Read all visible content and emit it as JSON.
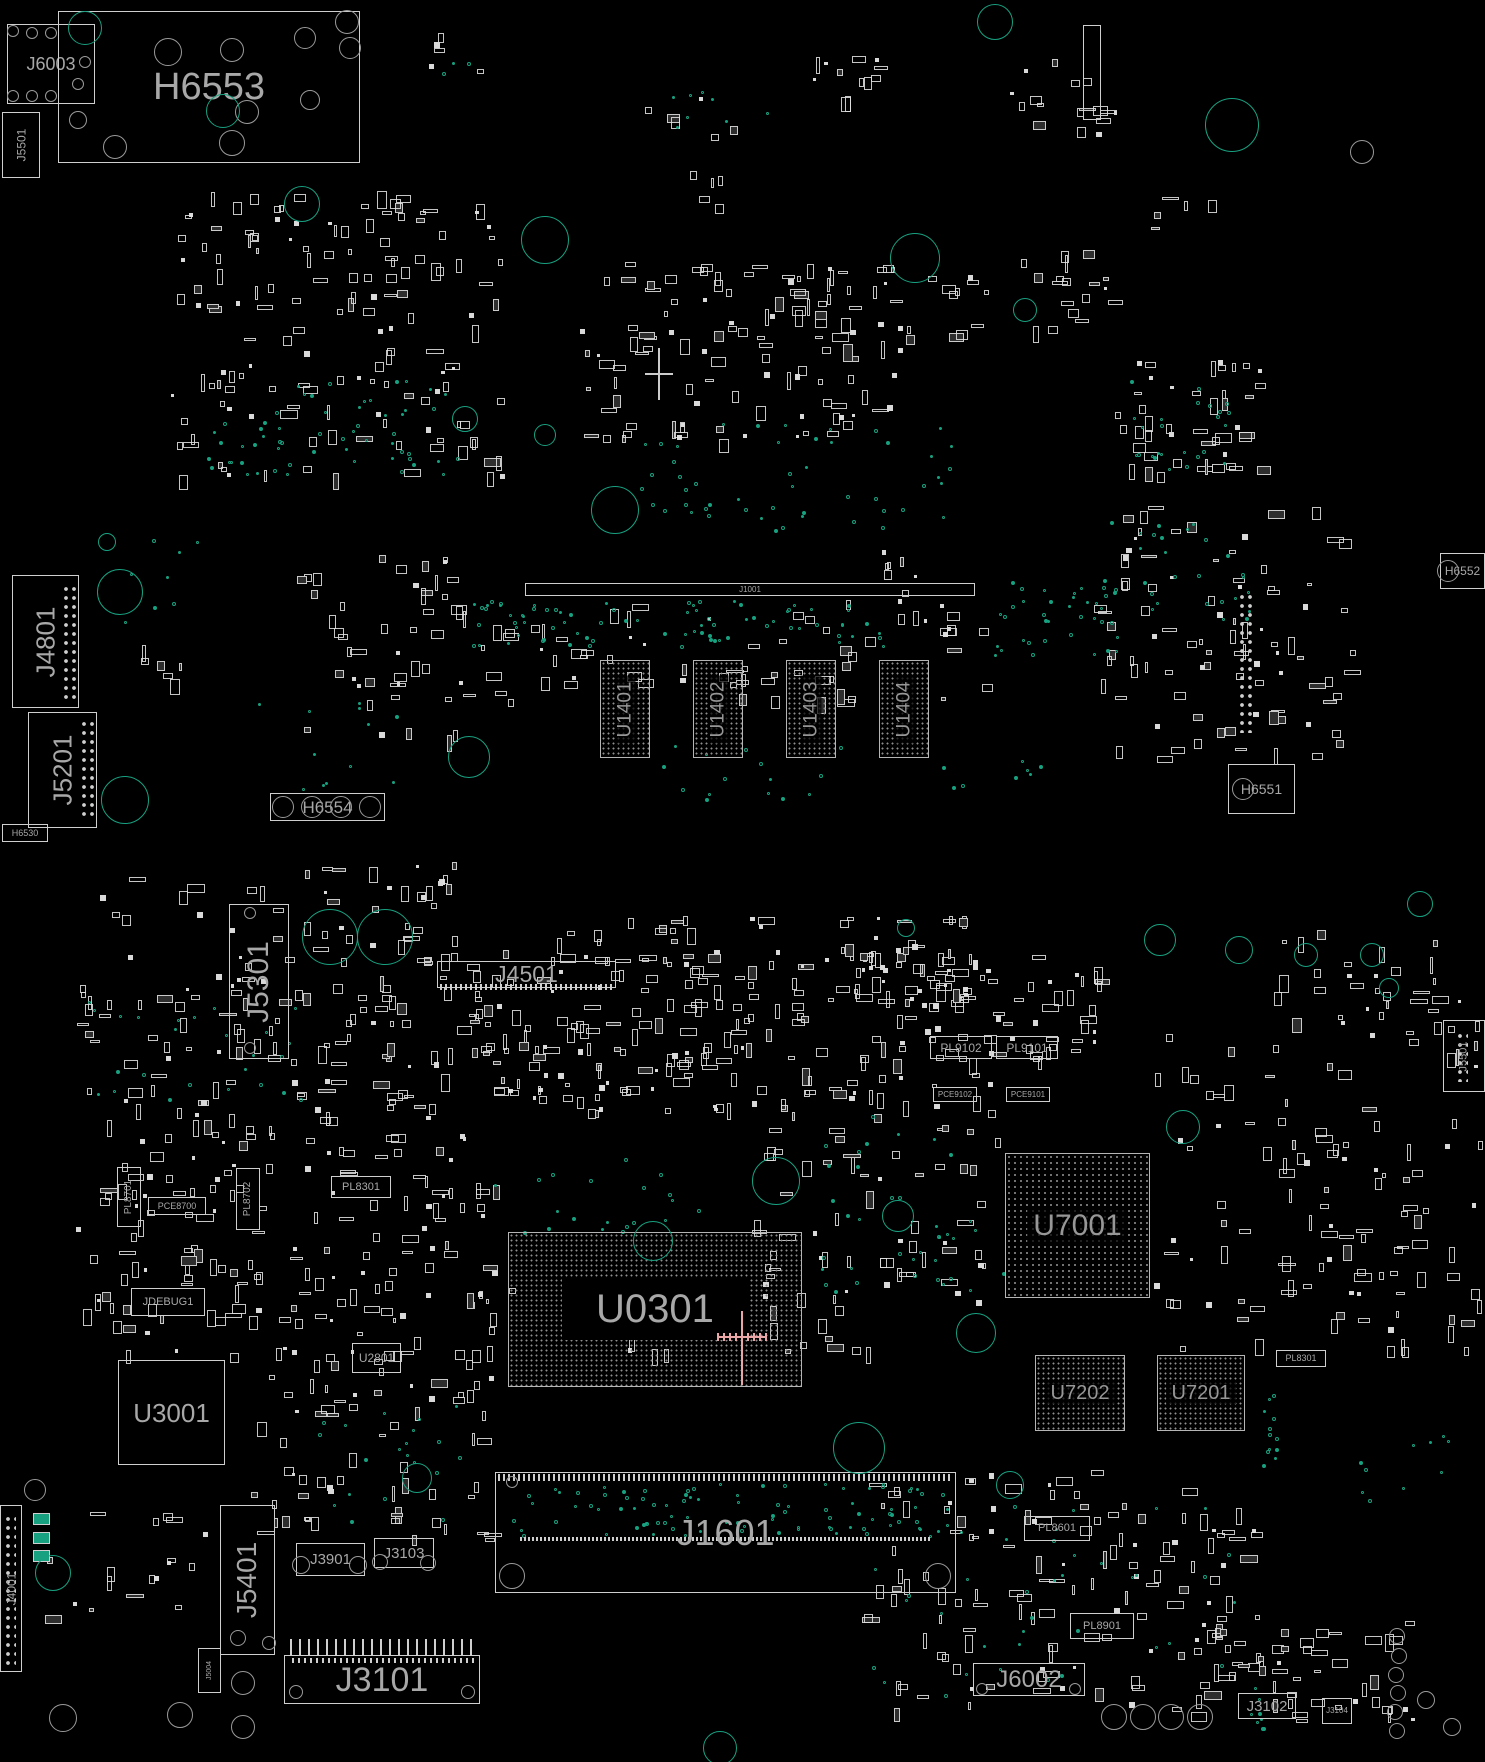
{
  "board": {
    "width": 1485,
    "height": 1762
  },
  "colors": {
    "background": "#000000",
    "outline": "#cfcfcf",
    "label": "#a8a8a8",
    "teal": "#17a180",
    "hole": "#9a9a9a",
    "highlight_cross": "#eaa6a6",
    "white_cross": "#cccccc",
    "bga_dot": "#8f8f8f",
    "pad_fill": "#d9d9d9"
  },
  "components": [
    {
      "label": "J6003",
      "x": 7,
      "y": 24,
      "w": 88,
      "h": 80,
      "type": "outline",
      "fs": 18,
      "dir": "h"
    },
    {
      "label": "H6553",
      "x": 58,
      "y": 11,
      "w": 302,
      "h": 152,
      "type": "outline",
      "fs": 38,
      "dir": "h"
    },
    {
      "label": "J5501",
      "x": 2,
      "y": 112,
      "w": 38,
      "h": 66,
      "type": "outline",
      "fs": 12,
      "dir": "v"
    },
    {
      "label": "J4801",
      "x": 12,
      "y": 575,
      "w": 67,
      "h": 133,
      "type": "outline",
      "fs": 26,
      "dir": "v"
    },
    {
      "label": "J5201",
      "x": 28,
      "y": 712,
      "w": 69,
      "h": 116,
      "type": "outline",
      "fs": 26,
      "dir": "v"
    },
    {
      "label": "H6530",
      "x": 2,
      "y": 824,
      "w": 46,
      "h": 18,
      "type": "outline",
      "fs": 9,
      "dir": "h"
    },
    {
      "label": "H6554",
      "x": 270,
      "y": 793,
      "w": 115,
      "h": 28,
      "type": "outline",
      "fs": 17,
      "dir": "h"
    },
    {
      "label": "J1001",
      "x": 525,
      "y": 583,
      "w": 450,
      "h": 13,
      "type": "outline",
      "fs": 8,
      "dir": "h"
    },
    {
      "label": "U1401",
      "x": 600,
      "y": 660,
      "w": 50,
      "h": 98,
      "type": "bga",
      "fs": 19,
      "dir": "v"
    },
    {
      "label": "U1402",
      "x": 693,
      "y": 660,
      "w": 50,
      "h": 98,
      "type": "bga",
      "fs": 19,
      "dir": "v"
    },
    {
      "label": "U1403",
      "x": 786,
      "y": 660,
      "w": 50,
      "h": 98,
      "type": "bga",
      "fs": 19,
      "dir": "v"
    },
    {
      "label": "U1404",
      "x": 879,
      "y": 660,
      "w": 50,
      "h": 98,
      "type": "bga",
      "fs": 19,
      "dir": "v"
    },
    {
      "label": "H6551",
      "x": 1228,
      "y": 764,
      "w": 67,
      "h": 50,
      "type": "outline",
      "fs": 14,
      "dir": "h"
    },
    {
      "label": "H6552",
      "x": 1440,
      "y": 553,
      "w": 45,
      "h": 36,
      "type": "outline",
      "fs": 12,
      "dir": "h"
    },
    {
      "label": "J5301",
      "x": 229,
      "y": 904,
      "w": 60,
      "h": 155,
      "type": "outline",
      "fs": 30,
      "dir": "v"
    },
    {
      "label": "J4501",
      "x": 437,
      "y": 961,
      "w": 179,
      "h": 27,
      "type": "outline",
      "fs": 23,
      "dir": "h"
    },
    {
      "label": "U0301",
      "x": 508,
      "y": 1232,
      "w": 294,
      "h": 155,
      "type": "bga",
      "fs": 40,
      "dir": "h",
      "panel": true
    },
    {
      "label": "U7001",
      "x": 1005,
      "y": 1153,
      "w": 145,
      "h": 145,
      "type": "bga",
      "fs": 30,
      "dir": "h"
    },
    {
      "label": "U7202",
      "x": 1035,
      "y": 1355,
      "w": 90,
      "h": 76,
      "type": "bga",
      "fs": 20,
      "dir": "h"
    },
    {
      "label": "U7201",
      "x": 1157,
      "y": 1355,
      "w": 88,
      "h": 76,
      "type": "bga",
      "fs": 20,
      "dir": "h"
    },
    {
      "label": "U3001",
      "x": 118,
      "y": 1360,
      "w": 107,
      "h": 105,
      "type": "outline",
      "fs": 26,
      "dir": "h"
    },
    {
      "label": "U2801",
      "x": 352,
      "y": 1343,
      "w": 49,
      "h": 30,
      "type": "outline",
      "fs": 12,
      "dir": "h"
    },
    {
      "label": "JDEBUG1",
      "x": 131,
      "y": 1288,
      "w": 74,
      "h": 28,
      "type": "outline",
      "fs": 11,
      "dir": "h"
    },
    {
      "label": "PL8701",
      "x": 117,
      "y": 1167,
      "w": 24,
      "h": 60,
      "type": "outline",
      "fs": 10,
      "dir": "v"
    },
    {
      "label": "PL8702",
      "x": 236,
      "y": 1168,
      "w": 24,
      "h": 62,
      "type": "outline",
      "fs": 10,
      "dir": "v"
    },
    {
      "label": "PCE8700",
      "x": 148,
      "y": 1197,
      "w": 58,
      "h": 18,
      "type": "outline",
      "fs": 9,
      "dir": "h"
    },
    {
      "label": "PL8301",
      "x": 331,
      "y": 1176,
      "w": 60,
      "h": 22,
      "type": "outline",
      "fs": 11,
      "dir": "h"
    },
    {
      "label": "PL9102",
      "x": 930,
      "y": 1036,
      "w": 62,
      "h": 23,
      "type": "outline",
      "fs": 12,
      "dir": "h"
    },
    {
      "label": "PL9101",
      "x": 996,
      "y": 1036,
      "w": 62,
      "h": 23,
      "type": "outline",
      "fs": 12,
      "dir": "h"
    },
    {
      "label": "PCE9102",
      "x": 933,
      "y": 1087,
      "w": 44,
      "h": 15,
      "type": "outline",
      "fs": 8,
      "dir": "h"
    },
    {
      "label": "PCE9101",
      "x": 1006,
      "y": 1087,
      "w": 44,
      "h": 15,
      "type": "outline",
      "fs": 8,
      "dir": "h"
    },
    {
      "label": "PL8301",
      "x": 1276,
      "y": 1350,
      "w": 50,
      "h": 17,
      "type": "outline",
      "fs": 9,
      "dir": "h"
    },
    {
      "label": "J1601",
      "x": 495,
      "y": 1472,
      "w": 461,
      "h": 121,
      "type": "outline",
      "fs": 36,
      "dir": "h"
    },
    {
      "label": "J5401",
      "x": 220,
      "y": 1505,
      "w": 55,
      "h": 150,
      "type": "outline",
      "fs": 28,
      "dir": "v"
    },
    {
      "label": "J3901",
      "x": 296,
      "y": 1543,
      "w": 69,
      "h": 33,
      "type": "outline",
      "fs": 15,
      "dir": "h"
    },
    {
      "label": "J3103",
      "x": 374,
      "y": 1538,
      "w": 60,
      "h": 30,
      "type": "outline",
      "fs": 15,
      "dir": "h"
    },
    {
      "label": "J3101",
      "x": 284,
      "y": 1655,
      "w": 196,
      "h": 49,
      "type": "outline",
      "fs": 34,
      "dir": "h"
    },
    {
      "label": "J5004",
      "x": 198,
      "y": 1648,
      "w": 23,
      "h": 45,
      "type": "outline",
      "fs": 7,
      "dir": "v"
    },
    {
      "label": "J4001",
      "x": 0,
      "y": 1505,
      "w": 22,
      "h": 167,
      "type": "outline",
      "fs": 12,
      "dir": "v"
    },
    {
      "label": "J6002",
      "x": 973,
      "y": 1663,
      "w": 112,
      "h": 33,
      "type": "outline",
      "fs": 24,
      "dir": "h"
    },
    {
      "label": "PL8601",
      "x": 1024,
      "y": 1516,
      "w": 66,
      "h": 25,
      "type": "outline",
      "fs": 11,
      "dir": "h"
    },
    {
      "label": "PL8901",
      "x": 1070,
      "y": 1613,
      "w": 64,
      "h": 26,
      "type": "outline",
      "fs": 11,
      "dir": "h"
    },
    {
      "label": "J3102",
      "x": 1238,
      "y": 1693,
      "w": 58,
      "h": 26,
      "type": "outline",
      "fs": 15,
      "dir": "h"
    },
    {
      "label": "J3104",
      "x": 1322,
      "y": 1698,
      "w": 30,
      "h": 26,
      "type": "outline",
      "fs": 8,
      "dir": "h"
    },
    {
      "label": "J5501",
      "x": 1443,
      "y": 1020,
      "w": 42,
      "h": 72,
      "type": "outline",
      "fs": 11,
      "dir": "v"
    },
    {
      "label": "",
      "x": 1083,
      "y": 25,
      "w": 18,
      "h": 95,
      "type": "outline",
      "fs": 0,
      "dir": "v"
    }
  ],
  "pad_columns": [
    [
      62,
      585,
      16,
      115
    ],
    [
      80,
      720,
      16,
      100
    ],
    [
      1238,
      593,
      16,
      140
    ],
    [
      4,
      1515,
      12,
      150
    ],
    [
      1456,
      1032,
      12,
      50
    ]
  ],
  "pin_strips": [
    [
      440,
      984,
      172,
      6,
      5
    ],
    [
      498,
      1474,
      455,
      7,
      5
    ],
    [
      520,
      1537,
      412,
      4,
      4
    ],
    [
      290,
      1639,
      186,
      16,
      9
    ],
    [
      292,
      1658,
      182,
      5,
      6
    ]
  ],
  "circles": [
    [
      168,
      52,
      14,
      "g"
    ],
    [
      232,
      50,
      12,
      "g"
    ],
    [
      305,
      38,
      11,
      "g"
    ],
    [
      347,
      22,
      12,
      "g"
    ],
    [
      350,
      48,
      11,
      "g"
    ],
    [
      310,
      100,
      10,
      "g"
    ],
    [
      232,
      143,
      13,
      "g"
    ],
    [
      115,
      147,
      12,
      "g"
    ],
    [
      247,
      112,
      12,
      "g"
    ],
    [
      78,
      120,
      9,
      "g"
    ],
    [
      13,
      31,
      6,
      "g"
    ],
    [
      32,
      33,
      6,
      "g"
    ],
    [
      51,
      33,
      6,
      "g"
    ],
    [
      13,
      96,
      6,
      "g"
    ],
    [
      32,
      96,
      6,
      "g"
    ],
    [
      51,
      96,
      6,
      "g"
    ],
    [
      85,
      62,
      6,
      "g"
    ],
    [
      78,
      84,
      6,
      "g"
    ],
    [
      283,
      807,
      11,
      "g"
    ],
    [
      312,
      807,
      11,
      "g"
    ],
    [
      341,
      807,
      11,
      "g"
    ],
    [
      370,
      807,
      11,
      "g"
    ],
    [
      1243,
      789,
      11,
      "g"
    ],
    [
      1448,
      571,
      11,
      "g"
    ],
    [
      512,
      1482,
      6,
      "g"
    ],
    [
      512,
      1576,
      13,
      "g"
    ],
    [
      938,
      1576,
      13,
      "g"
    ],
    [
      296,
      1692,
      7,
      "g"
    ],
    [
      468,
      1692,
      7,
      "g"
    ],
    [
      1114,
      1717,
      13,
      "g"
    ],
    [
      1143,
      1717,
      13,
      "g"
    ],
    [
      1171,
      1717,
      13,
      "g"
    ],
    [
      1200,
      1717,
      13,
      "g"
    ],
    [
      35,
      1490,
      11,
      "g"
    ],
    [
      63,
      1718,
      14,
      "g"
    ],
    [
      180,
      1715,
      13,
      "g"
    ],
    [
      243,
      1683,
      12,
      "g"
    ],
    [
      243,
      1727,
      12,
      "g"
    ],
    [
      1397,
      1636,
      8,
      "g"
    ],
    [
      1399,
      1656,
      8,
      "g"
    ],
    [
      1396,
      1675,
      8,
      "g"
    ],
    [
      1398,
      1693,
      8,
      "g"
    ],
    [
      1395,
      1712,
      8,
      "g"
    ],
    [
      1397,
      1731,
      8,
      "g"
    ],
    [
      1426,
      1700,
      9,
      "g"
    ],
    [
      1452,
      1727,
      9,
      "g"
    ],
    [
      250,
      913,
      6,
      "g"
    ],
    [
      250,
      1048,
      6,
      "g"
    ],
    [
      238,
      1638,
      8,
      "g"
    ],
    [
      269,
      1643,
      7,
      "g"
    ],
    [
      301,
      1565,
      9,
      "g"
    ],
    [
      358,
      1565,
      9,
      "g"
    ],
    [
      380,
      1562,
      8,
      "g"
    ],
    [
      428,
      1563,
      8,
      "g"
    ],
    [
      982,
      1689,
      6,
      "g"
    ],
    [
      1075,
      1689,
      6,
      "g"
    ],
    [
      1362,
      152,
      12,
      "g"
    ],
    [
      85,
      28,
      17,
      "t"
    ],
    [
      223,
      111,
      17,
      "t"
    ],
    [
      302,
      204,
      18,
      "t"
    ],
    [
      545,
      240,
      24,
      "t"
    ],
    [
      915,
      258,
      25,
      "t"
    ],
    [
      465,
      419,
      13,
      "t"
    ],
    [
      545,
      435,
      11,
      "t"
    ],
    [
      1025,
      310,
      12,
      "t"
    ],
    [
      1232,
      125,
      27,
      "t"
    ],
    [
      995,
      22,
      18,
      "t"
    ],
    [
      120,
      592,
      23,
      "t"
    ],
    [
      107,
      542,
      9,
      "t"
    ],
    [
      615,
      510,
      24,
      "t"
    ],
    [
      469,
      757,
      21,
      "t"
    ],
    [
      125,
      800,
      24,
      "t"
    ],
    [
      330,
      937,
      28,
      "t"
    ],
    [
      385,
      937,
      28,
      "t"
    ],
    [
      976,
      1333,
      20,
      "t"
    ],
    [
      859,
      1448,
      26,
      "t"
    ],
    [
      1160,
      940,
      16,
      "t"
    ],
    [
      1239,
      950,
      14,
      "t"
    ],
    [
      1306,
      955,
      12,
      "t"
    ],
    [
      1372,
      955,
      12,
      "t"
    ],
    [
      1389,
      988,
      10,
      "t"
    ],
    [
      720,
      1748,
      17,
      "t"
    ],
    [
      1010,
      1485,
      14,
      "t"
    ],
    [
      653,
      1241,
      20,
      "t"
    ],
    [
      776,
      1181,
      24,
      "t"
    ],
    [
      898,
      1216,
      16,
      "t"
    ],
    [
      906,
      928,
      9,
      "t"
    ],
    [
      1420,
      904,
      13,
      "t"
    ],
    [
      53,
      1573,
      18,
      "t"
    ],
    [
      1183,
      1127,
      17,
      "t"
    ],
    [
      417,
      1478,
      15,
      "t"
    ]
  ],
  "teal_pads": [
    [
      33,
      1513,
      17,
      12
    ],
    [
      33,
      1532,
      17,
      12
    ],
    [
      33,
      1550,
      17,
      12
    ]
  ],
  "via_clusters": [
    [
      250,
      380,
      210,
      95,
      40,
      51
    ],
    [
      180,
      420,
      150,
      55,
      18,
      52
    ],
    [
      640,
      420,
      310,
      110,
      50,
      53
    ],
    [
      470,
      600,
      420,
      45,
      80,
      54
    ],
    [
      985,
      580,
      135,
      75,
      35,
      55
    ],
    [
      100,
      530,
      100,
      95,
      8,
      56
    ],
    [
      250,
      700,
      150,
      90,
      12,
      57
    ],
    [
      640,
      745,
      200,
      55,
      15,
      58
    ],
    [
      940,
      760,
      100,
      40,
      8,
      59
    ],
    [
      1100,
      520,
      150,
      100,
      30,
      60
    ],
    [
      1130,
      380,
      100,
      90,
      25,
      61
    ],
    [
      510,
      1483,
      440,
      52,
      90,
      62
    ],
    [
      80,
      1000,
      220,
      100,
      25,
      63
    ],
    [
      480,
      1150,
      220,
      100,
      20,
      64
    ],
    [
      820,
      1100,
      140,
      200,
      25,
      65
    ],
    [
      1262,
      1380,
      14,
      100,
      12,
      66
    ],
    [
      860,
      1500,
      390,
      200,
      40,
      67
    ],
    [
      300,
      1400,
      180,
      120,
      20,
      68
    ],
    [
      1246,
      1670,
      16,
      85,
      8,
      69
    ],
    [
      660,
      90,
      120,
      40,
      8,
      70
    ],
    [
      430,
      55,
      40,
      20,
      3,
      71
    ],
    [
      905,
      1210,
      100,
      80,
      12,
      72
    ],
    [
      1330,
      1430,
      120,
      80,
      10,
      73
    ]
  ],
  "scatter_clusters": [
    [
      170,
      190,
      330,
      290,
      150,
      1
    ],
    [
      580,
      260,
      320,
      180,
      120,
      2
    ],
    [
      1110,
      360,
      150,
      120,
      45,
      3
    ],
    [
      1020,
      250,
      90,
      80,
      18,
      4
    ],
    [
      905,
      270,
      95,
      70,
      12,
      5
    ],
    [
      290,
      555,
      170,
      185,
      45,
      6
    ],
    [
      450,
      600,
      540,
      100,
      70,
      7
    ],
    [
      1090,
      505,
      260,
      255,
      90,
      8
    ],
    [
      1010,
      55,
      125,
      80,
      18,
      9
    ],
    [
      810,
      55,
      70,
      45,
      12,
      10
    ],
    [
      570,
      90,
      190,
      45,
      6,
      11
    ],
    [
      125,
      640,
      60,
      60,
      6,
      12
    ],
    [
      880,
      550,
      60,
      70,
      10,
      13
    ],
    [
      1150,
      180,
      75,
      50,
      5,
      14
    ],
    [
      420,
      30,
      60,
      45,
      5,
      15
    ],
    [
      680,
      170,
      60,
      40,
      5,
      16
    ],
    [
      75,
      955,
      395,
      400,
      260,
      21
    ],
    [
      470,
      950,
      275,
      160,
      130,
      22
    ],
    [
      745,
      950,
      255,
      160,
      90,
      23
    ],
    [
      1000,
      950,
      100,
      110,
      30,
      24
    ],
    [
      745,
      1110,
      255,
      190,
      60,
      25
    ],
    [
      1150,
      1010,
      330,
      340,
      120,
      26
    ],
    [
      250,
      1345,
      250,
      195,
      70,
      27
    ],
    [
      30,
      1470,
      180,
      150,
      18,
      28
    ],
    [
      860,
      1470,
      400,
      240,
      130,
      29
    ],
    [
      1190,
      1620,
      230,
      100,
      50,
      30
    ],
    [
      610,
      1290,
      260,
      70,
      25,
      31
    ],
    [
      440,
      1150,
      70,
      180,
      18,
      32
    ],
    [
      1270,
      925,
      190,
      85,
      25,
      33
    ],
    [
      837,
      915,
      134,
      90,
      50,
      34
    ],
    [
      555,
      915,
      205,
      45,
      20,
      35
    ],
    [
      301,
      859,
      157,
      100,
      35,
      36
    ],
    [
      100,
      860,
      180,
      80,
      12,
      38
    ]
  ],
  "crosshairs": [
    {
      "x": 659,
      "y": 374,
      "up": 26,
      "down": 26,
      "left": 14,
      "right": 14,
      "color": "#cccccc",
      "ticks": false
    },
    {
      "x": 742,
      "y": 1337,
      "up": 26,
      "down": 48,
      "left": 24,
      "right": 24,
      "color": "#eaa6a6",
      "ticks": true
    }
  ]
}
